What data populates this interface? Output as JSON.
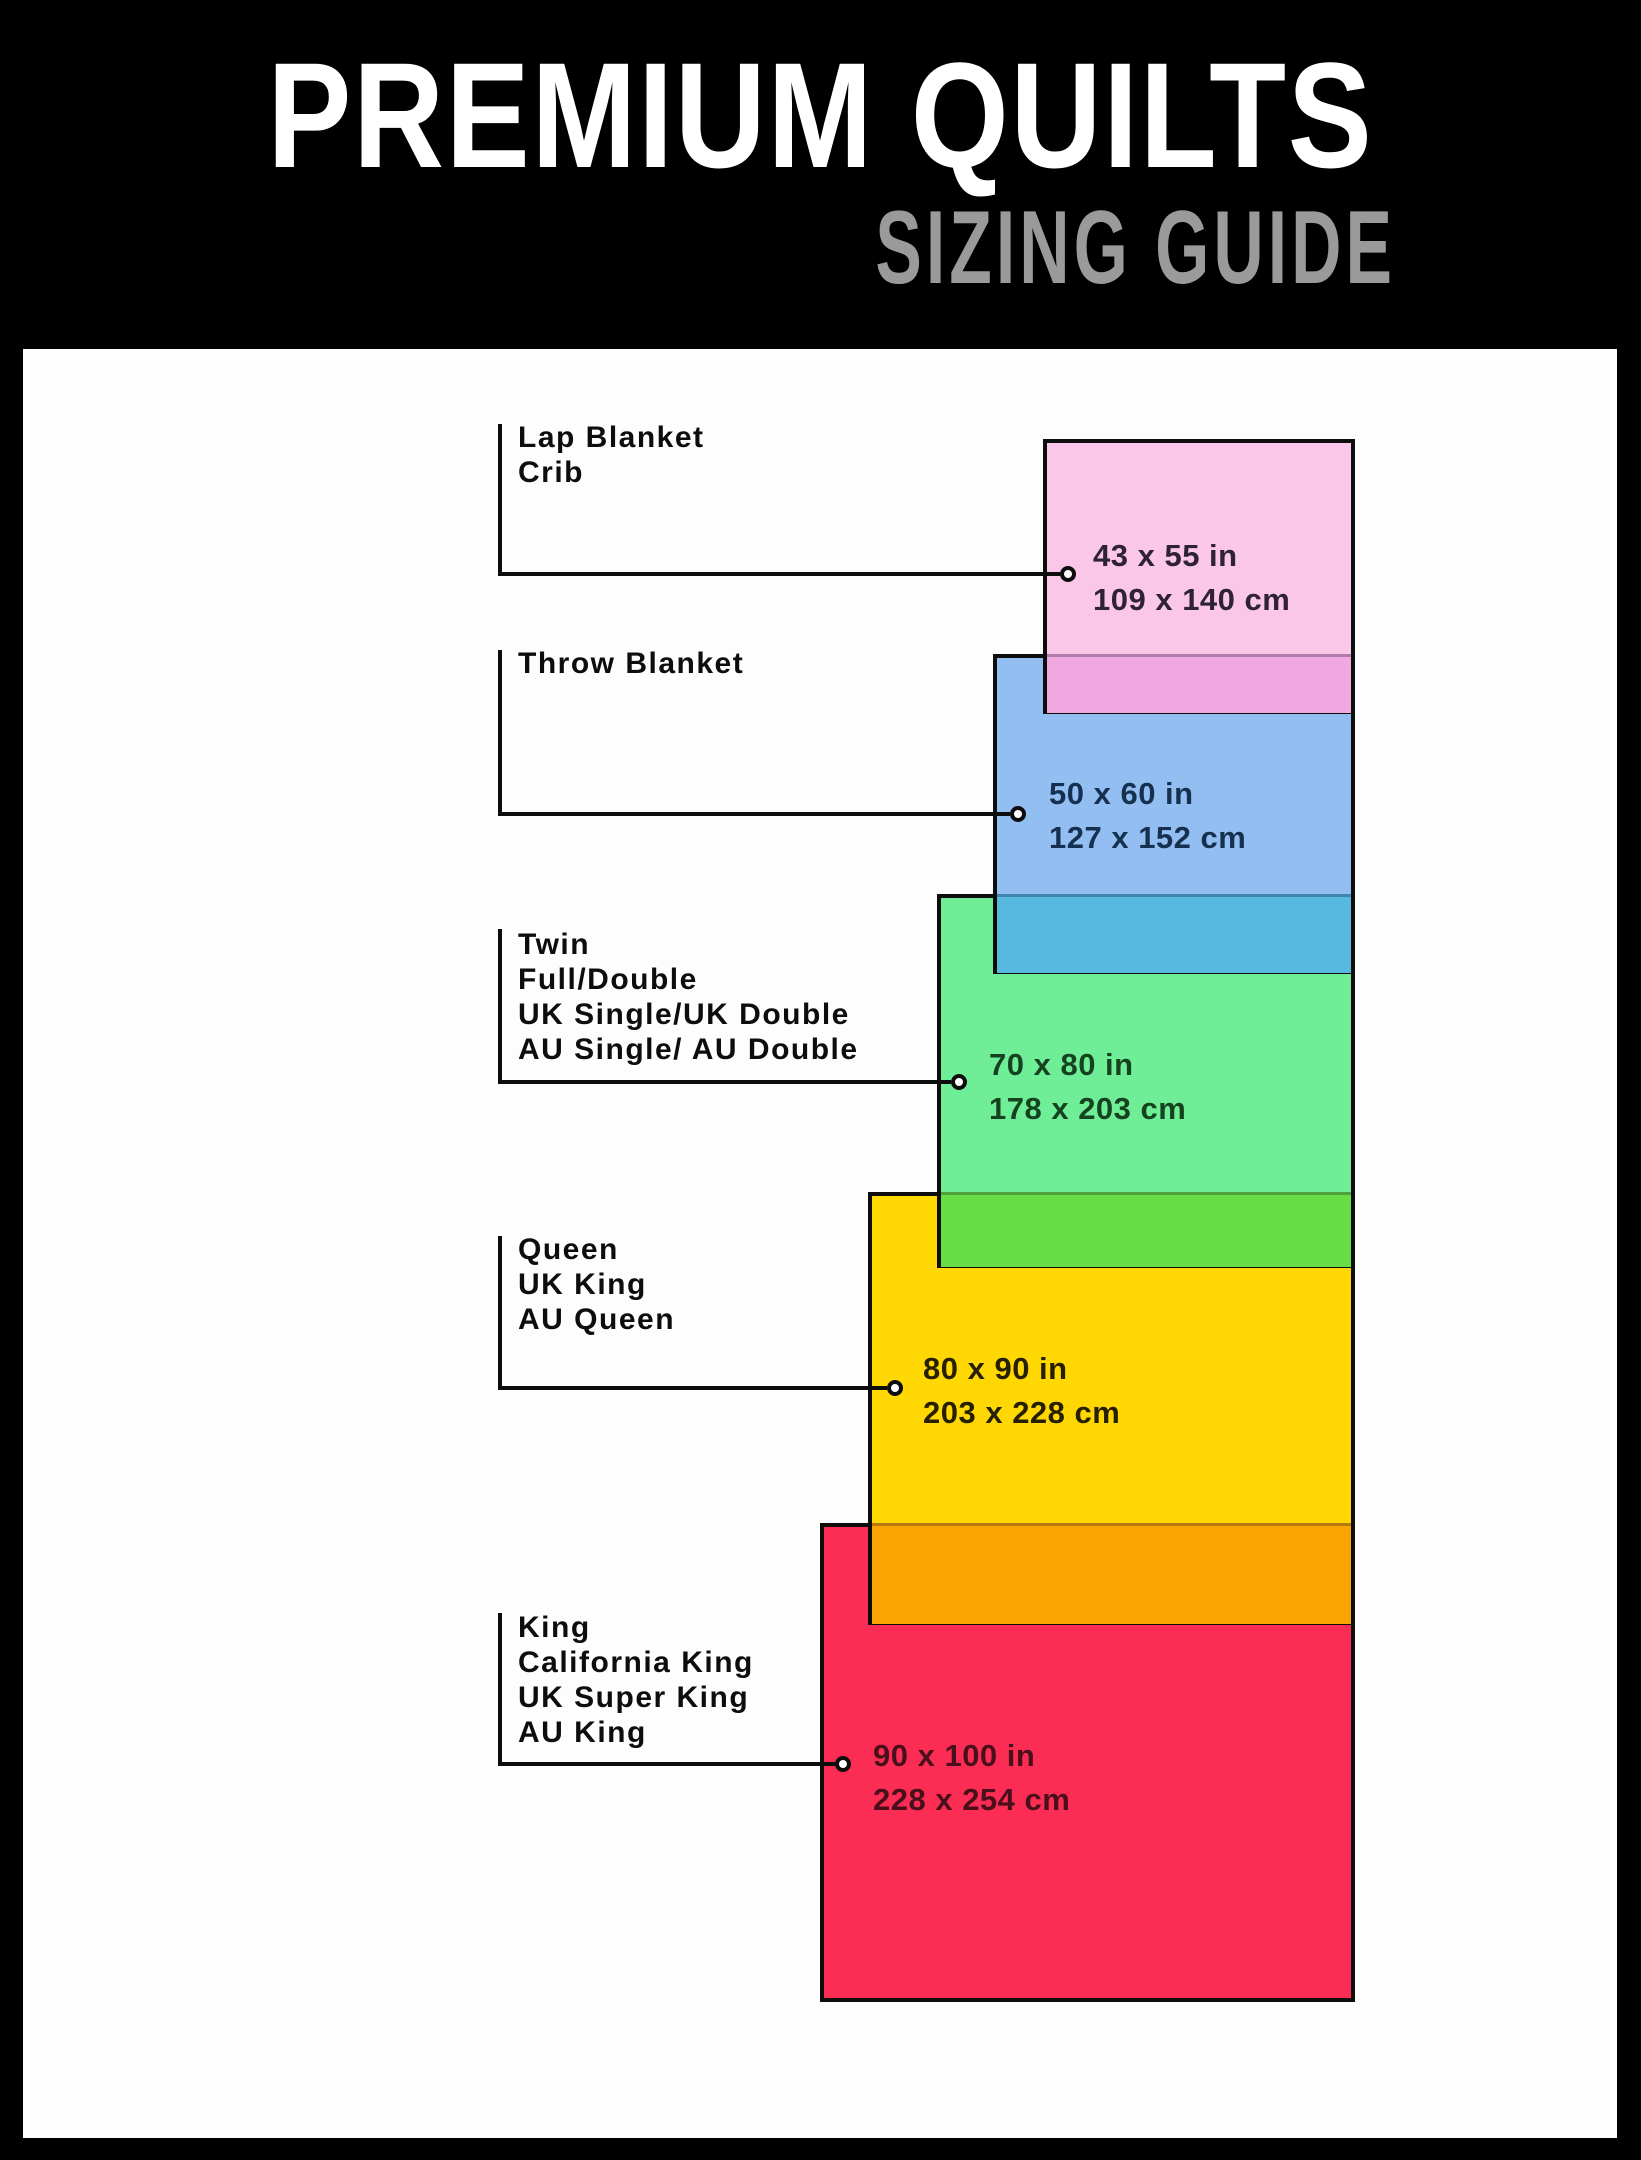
{
  "header": {
    "title": "PREMIUM QUILTS",
    "subtitle": "SIZING GUIDE"
  },
  "sizes": [
    {
      "id": "lap",
      "labels": [
        "Lap Blanket",
        "Crib"
      ],
      "inches": "43 x 55 in",
      "cm": "109 x 140 cm",
      "fill": "#fbc7e9",
      "overlap_blend": "#f0a8e1",
      "text_color": "#2f2235"
    },
    {
      "id": "throw",
      "labels": [
        "Throw Blanket"
      ],
      "inches": "50 x 60 in",
      "cm": "127 x 152 cm",
      "fill": "#93bef1",
      "overlap_blend": "#57b8e0",
      "text_color": "#16304f"
    },
    {
      "id": "twin",
      "labels": [
        "Twin",
        "Full/Double",
        "UK Single/UK Double",
        "AU Single/ AU Double"
      ],
      "inches": "70 x 80 in",
      "cm": "178 x 203 cm",
      "fill": "#70ee97",
      "overlap_blend": "#68dd45",
      "text_color": "#15431f"
    },
    {
      "id": "queen",
      "labels": [
        "Queen",
        "UK King",
        "AU Queen"
      ],
      "inches": "80 x 90 in",
      "cm": "203 x 228 cm",
      "fill": "#ffd702",
      "overlap_blend": "#f9a402",
      "text_color": "#262000"
    },
    {
      "id": "king",
      "labels": [
        "King",
        "California King",
        "UK Super King",
        "AU King"
      ],
      "inches": "90 x 100 in",
      "cm": "228 x 254 cm",
      "fill": "#fb2d55",
      "overlap_blend": null,
      "text_color": "#49101c"
    }
  ],
  "colors": {
    "frame": "#000000",
    "panel": "#fdfdfd",
    "title": "#ffffff",
    "subtitle": "#9a9a9a",
    "line": "#0d0d0d"
  }
}
